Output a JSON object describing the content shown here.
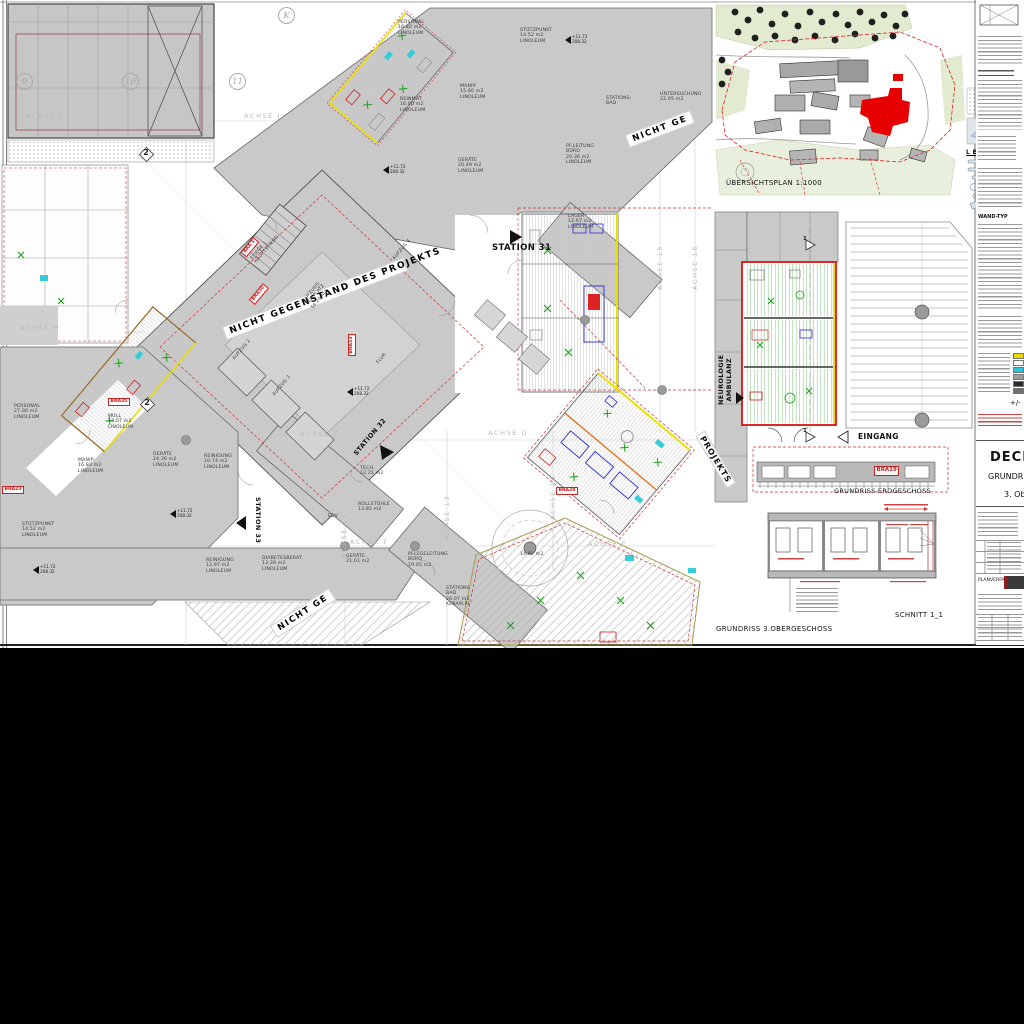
{
  "main": {
    "banner": "NICHT GEGENSTAND DES PROJEKTS",
    "banner_short": "NICHT GE",
    "stations": [
      "STATION 31",
      "STATION 32",
      "STATION 33"
    ],
    "axes": {
      "h": [
        "ACHSE J",
        "ACHSE H",
        "ACHSE G",
        "ACHSE F",
        "ACHSE E"
      ],
      "v": [
        "ACHSE 12",
        "ACHSE 13",
        "ACHSE 14",
        "ACHSE 15",
        "ACHSE 16"
      ]
    },
    "bubbles": [
      "9",
      "10",
      "11",
      "K",
      "2"
    ],
    "bra": [
      "BRA 1",
      "BRA30",
      "BRA13",
      "BRA23",
      "BRA35",
      "BRA28",
      "BRA19"
    ],
    "elev_marker": "+11.72\n208.32",
    "rooms": [
      "PERSONAL\n16.82 m2\nLINOLEUM",
      "STÜTZPUNKT\n14.52 m2\nLINOLEUM",
      "MANIP.\n15.66 m2\nLINOLEUM",
      "REINMAT.\n16.00 m2\nLINOLEUM",
      "GERÄTE\n20.49 m2\nLINOLEUM",
      "PF.LEITUNG\nBÜRO\n20.36 m2\nLINOLEUM",
      "STATIONS-\nBAD",
      "UNTERSUCHUNG\n22.05 m2",
      "LAGER\n12.67 m2\nLINOLEUM",
      "STIEGE 1\nHAUPTSTIEGE",
      "AUFZUGS-\nVORPLATZ\n56.20 m2",
      "AUFZUG 2",
      "AUFZUG 3",
      "AUFZUG 4",
      "FLUR",
      "PERSONAL\n27.06 m2\nLINOLEUM",
      "MÜLL\n13.07 m2\nLINOLEUM",
      "GERÄTE\n24.36 m2\nLINOLEUM",
      "MANIP\n16.83 m2\nLINOLEUM",
      "REINIGUNG\n10.74 m2\nLINOLEUM",
      "STÜTZPUNKT\n14.52 m2\nLINOLEUM",
      "REINIGUNG\n12.97 m2\nLINOLEUM",
      "DIABETESBERAT.\n13.39 m2\nLINOLEUM",
      "GERÄTE\n21.61 m2",
      "ROLLSTÜHLE\n13.85 m2",
      "EDV",
      "PFLEGELEITUNG\nBÜRO\n19.05 m2",
      "STATIONS\nBAD\n26.07 m2\nKERAM.PL",
      "TECH.\n12.21 m2",
      "14.82 m2"
    ]
  },
  "site": {
    "caption": "ÜBERSICHTSPLAN 1:1000",
    "legend_title": "L E G E N D E :"
  },
  "detail": {
    "caption": "GRUNDRISS ERDGESCHOSS",
    "entrance": "EINGANG",
    "department": "NEUROLOGIE\nAMBULANZ",
    "projekts": "PROJEKTS",
    "section_no": "1"
  },
  "section": {
    "caption": "SCHNITT 1_1",
    "plan_caption": "GRUNDRISS 3.OBERGESCHOSS"
  },
  "titleblock": {
    "wand_typ": "WAND-TYP",
    "plusminus": "+/-",
    "title_fragment1": "DECKE",
    "title_fragment2": "GRUNDRIS",
    "title_fragment3": "3. Ob",
    "planverfasser": "PLANVERFASSER",
    "swatches": [
      "#ead900",
      "#ffffff",
      "#2fc4d6",
      "#9e9e9e",
      "#2a2a2a",
      "#6f6f6f"
    ]
  },
  "colors": {
    "red_accent": "#dd1111",
    "highlight_yellow": "#ece000",
    "renovation_green": "#18a018",
    "cyan": "#35ccd8",
    "blue": "#2a2acc",
    "building_gray": "#c9c9c9"
  }
}
